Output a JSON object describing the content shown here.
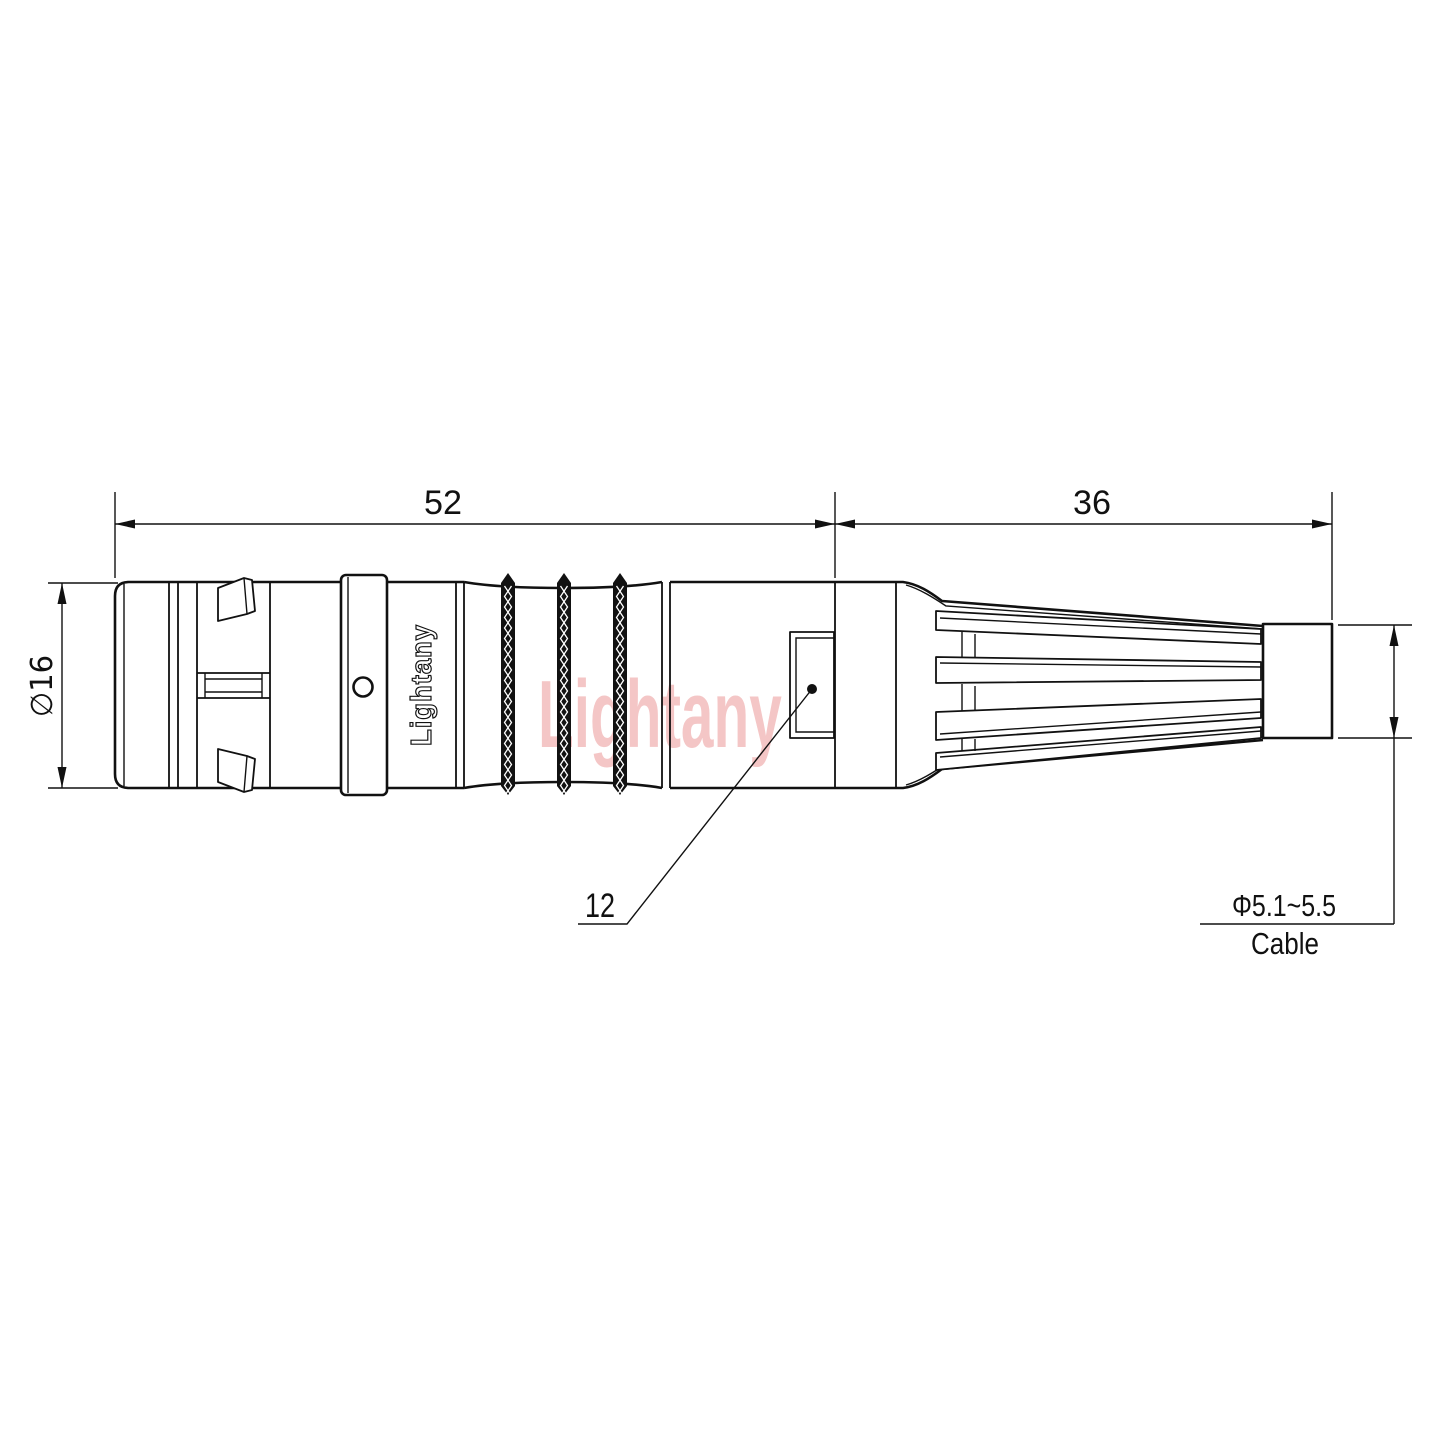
{
  "drawing": {
    "kind": "connector-technical-drawing",
    "dimensions": {
      "front_length": "52",
      "boot_length": "36",
      "body_diameter": "∅16",
      "key_size": "12",
      "cable_range": "Φ5.1~5.5",
      "cable_caption": "Cable"
    },
    "branding": {
      "body_text": "Lightany",
      "watermark": "Lightany"
    },
    "colors": {
      "line": "#111111",
      "watermark_pink": "#f4c6c6",
      "background": "#ffffff"
    }
  }
}
